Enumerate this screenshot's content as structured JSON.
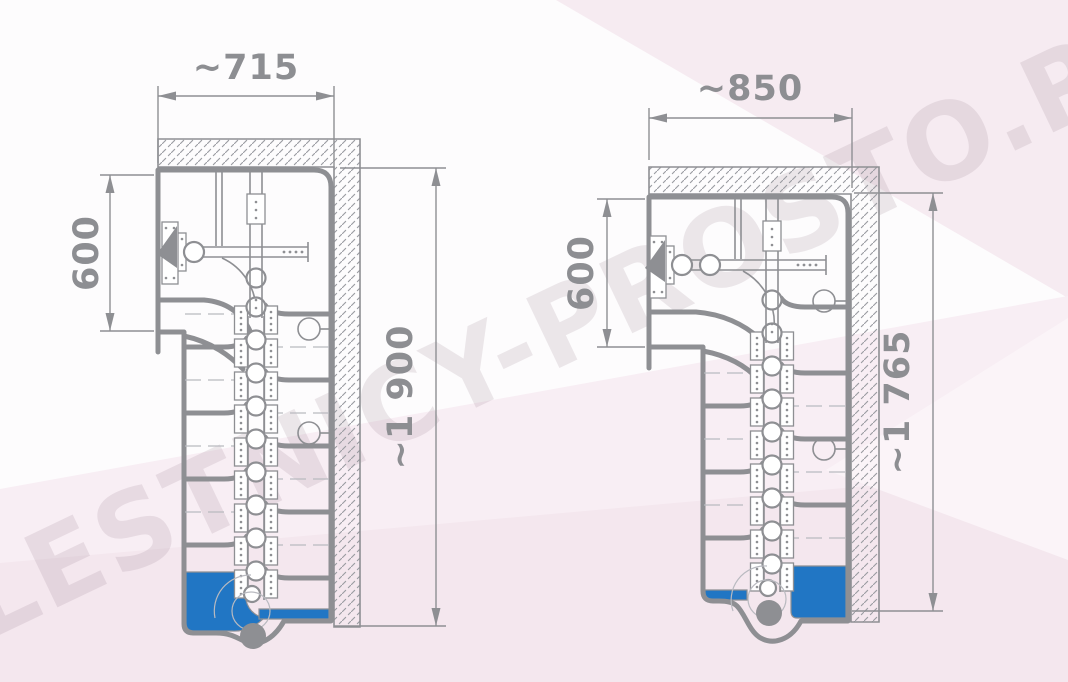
{
  "watermark_text": "LESTNICY-PROSTO.RU",
  "colors": {
    "line": "#8e8f93",
    "lite": "#b9bac0",
    "blue": "#2176c4",
    "dim_text": "#8d8e92",
    "watermark": "#8a7080",
    "bg_lower": "#f8eef4",
    "bg_band": "#f4e7ee",
    "bg_top": "#f6ebf1",
    "bg_notch": "#fbf4f8"
  },
  "plans": {
    "left": {
      "title": "compact goose-step staircase plan, narrow variant",
      "width_label": "~715",
      "opening_label": "600",
      "length_label": "~1 900"
    },
    "right": {
      "title": "compact goose-step staircase plan, wide variant",
      "width_label": "~850",
      "opening_label": "600",
      "length_label": "~1 765"
    }
  }
}
